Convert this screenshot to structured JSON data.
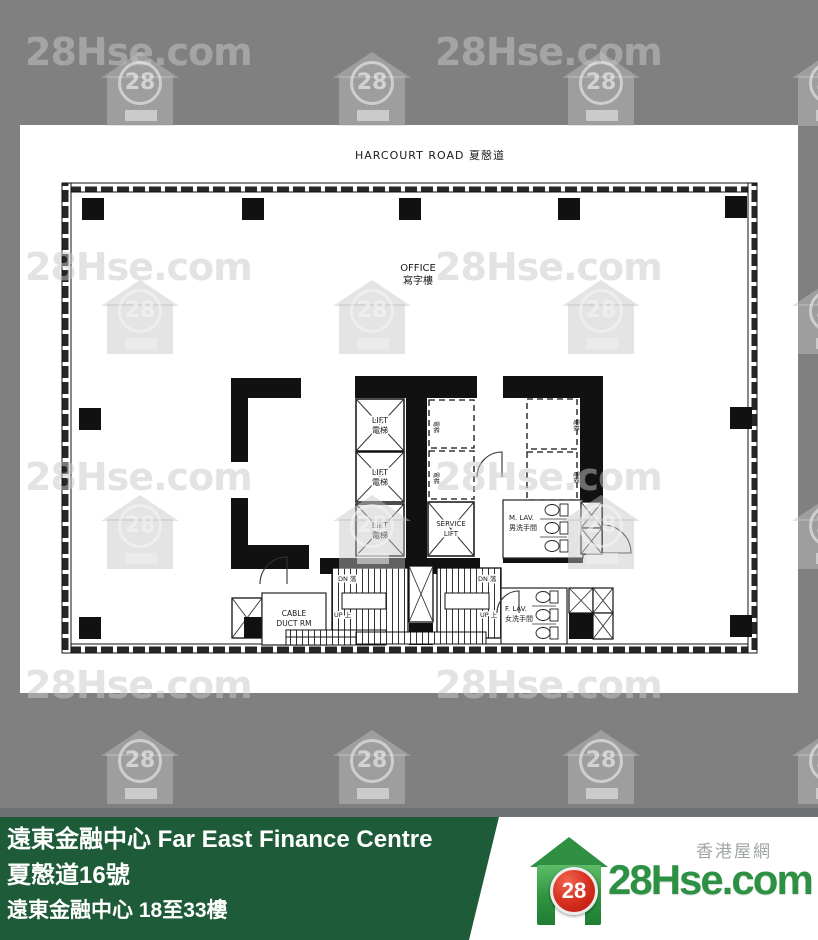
{
  "page": {
    "background": "#808080"
  },
  "watermark": {
    "text": "28Hse.com",
    "logo_number": "28"
  },
  "plan": {
    "road_label": "HARCOURT ROAD 夏慤道",
    "zone_label_en": "OFFICE",
    "zone_label_zh": "寫字樓",
    "lift": {
      "en": "LIFT",
      "zh": "電梯"
    },
    "service_lift": {
      "line1": "SERVICE",
      "line2": "LIFT"
    },
    "male_lav": {
      "line1": "M. LAV.",
      "line2": "男洗手間"
    },
    "female_lav": {
      "line1": "F. LAV.",
      "line2": "女洗手間"
    },
    "cable_room": {
      "line1": "CABLE",
      "line2": "DUCT RM"
    },
    "stair_down": "DN 落",
    "stair_up": "UP 上",
    "shaft_label_zh": "電梯"
  },
  "footer": {
    "line1": "遠東金融中心 Far East Finance Centre",
    "line2": "夏慤道16號",
    "line3": "遠東金融中心 18至33樓",
    "green_color": "#1E5B38",
    "brand": {
      "site_zh": "香港屋網",
      "name": "28Hse.com",
      "number": "28",
      "red_color": "#BC1407",
      "green_color": "#2D9144"
    }
  }
}
